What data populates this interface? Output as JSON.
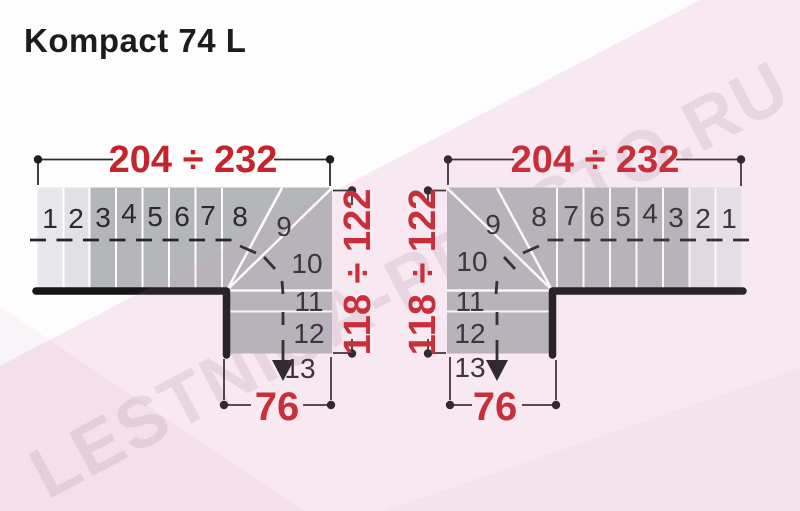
{
  "title": "Kompact 74 L",
  "watermark": "LESTNICA-PROSTO.RU",
  "colors": {
    "dimension_red": "#c5242c",
    "step_light": "#e7e6ea",
    "step_light2": "#e1e0e4",
    "step_dark": "#b4b6b9",
    "wall": "#161616"
  },
  "diagrams": {
    "left": {
      "width_label": "204 ÷ 232",
      "height_label": "118 ÷ 122",
      "depth_label": "76",
      "steps": [
        "1",
        "2",
        "3",
        "4",
        "5",
        "6",
        "7",
        "8",
        "9",
        "10",
        "11",
        "12",
        "13"
      ]
    },
    "right": {
      "width_label": "204 ÷ 232",
      "height_label": "118 ÷ 122",
      "depth_label": "76",
      "steps": [
        "1",
        "2",
        "3",
        "4",
        "5",
        "6",
        "7",
        "8",
        "9",
        "10",
        "11",
        "12",
        "13"
      ]
    }
  }
}
